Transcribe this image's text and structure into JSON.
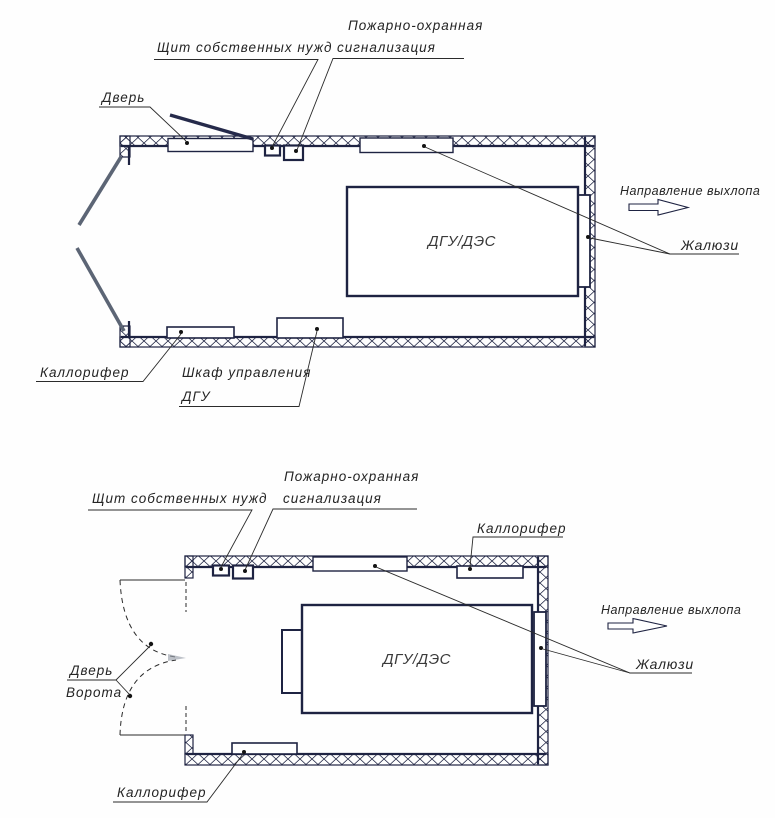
{
  "colors": {
    "line": "#1e2342",
    "door_gray": "#5c6575",
    "text": "#242424"
  },
  "diagrams": [
    {
      "labels": {
        "panel": "Щит собственных нужд",
        "fire1": "Пожарно-охранная",
        "fire2": "сигнализация",
        "door": "Дверь",
        "generator": "ДГУ/ДЭС",
        "exhaust": "Направление выхлопа",
        "louvers": "Жалюзи",
        "heater": "Каллорифер",
        "cabinet1": "Шкаф управления",
        "cabinet2": "ДГУ"
      }
    },
    {
      "labels": {
        "panel": "Щит собственных нужд",
        "fire1": "Пожарно-охранная",
        "fire2": "сигнализация",
        "heater_top": "Каллорифер",
        "generator": "ДГУ/ДЭС",
        "exhaust": "Направление выхлопа",
        "louvers": "Жалюзи",
        "door": "Дверь",
        "gate": "Ворота",
        "heater_bottom": "Каллорифер"
      }
    }
  ]
}
